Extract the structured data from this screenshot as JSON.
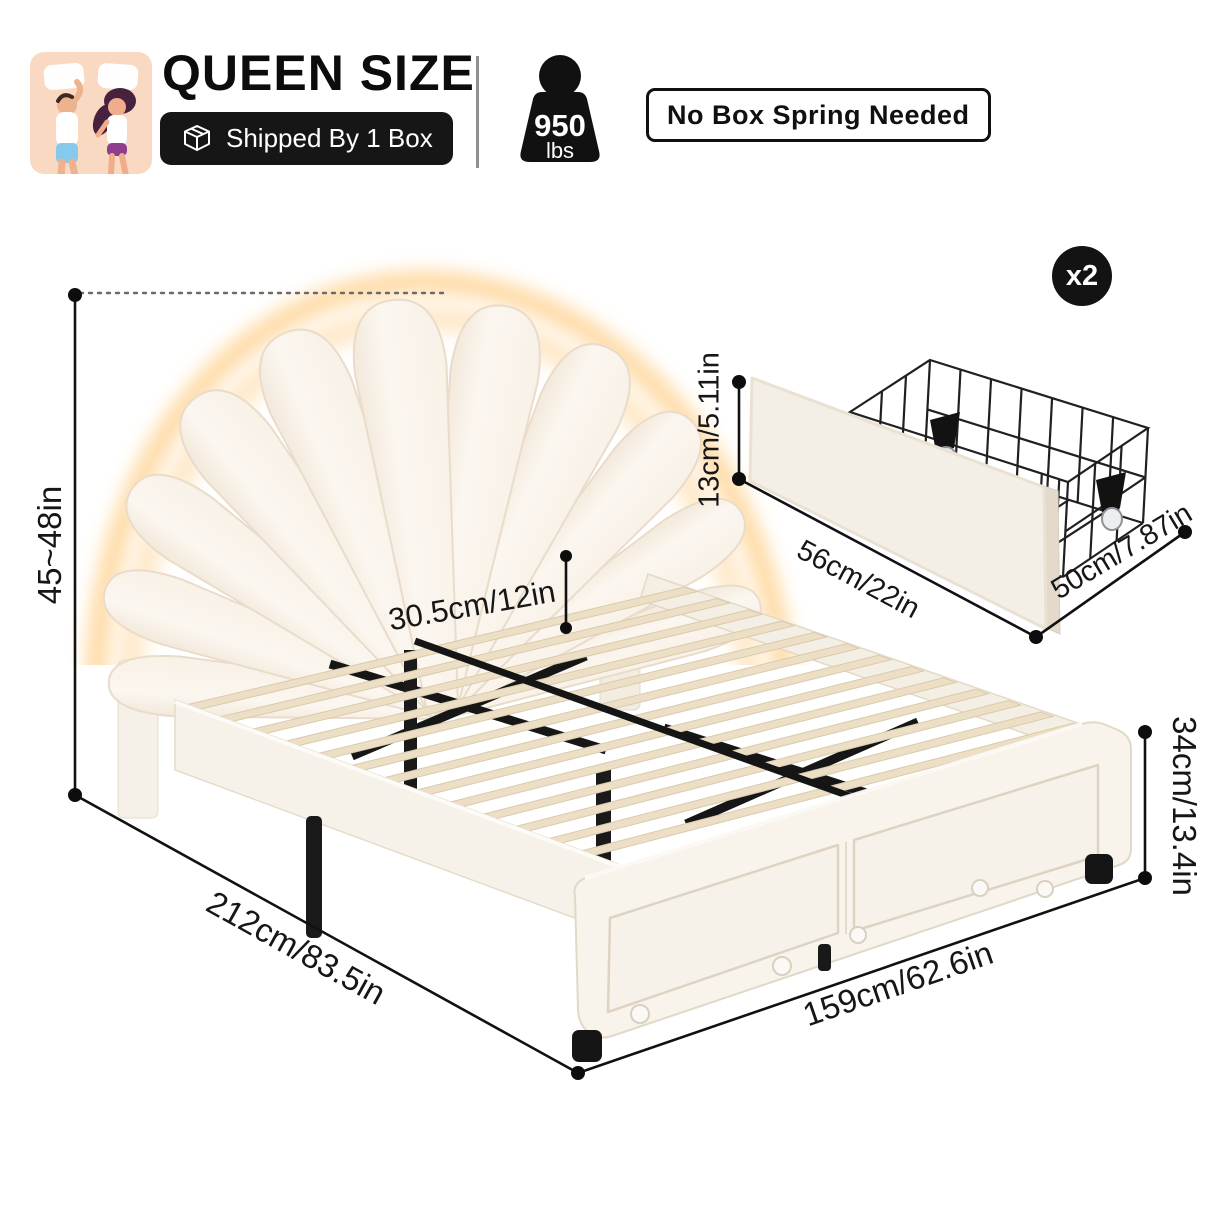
{
  "header": {
    "size_label": "QUEEN SIZE",
    "shipping_badge": "Shipped By 1 Box",
    "weight_capacity": {
      "value": "950",
      "unit": "lbs"
    },
    "feature_badge": "No Box Spring Needed"
  },
  "bed_dimensions": {
    "height_range": "45~48in",
    "headboard_clearance": "30.5cm/12in",
    "length": "212cm/83.5in",
    "width": "159cm/62.6in",
    "footboard_height": "34cm/13.4in"
  },
  "storage_drawer": {
    "quantity_badge": "x2",
    "height": "13cm/5.11in",
    "width": "56cm/22in",
    "depth": "50cm/7.87in"
  },
  "icons": {
    "sleepers": "two-sleepers-icon",
    "box": "shipping-box-icon",
    "weight": "weight-capacity-icon"
  },
  "colors": {
    "accent_black": "#141414",
    "upholstery_cream": "#f8f3eb",
    "slat_wood": "#ecdfc5",
    "glow_warm": "#ffd9a2",
    "sleeper_icon_bg": "#f9d9c2"
  }
}
